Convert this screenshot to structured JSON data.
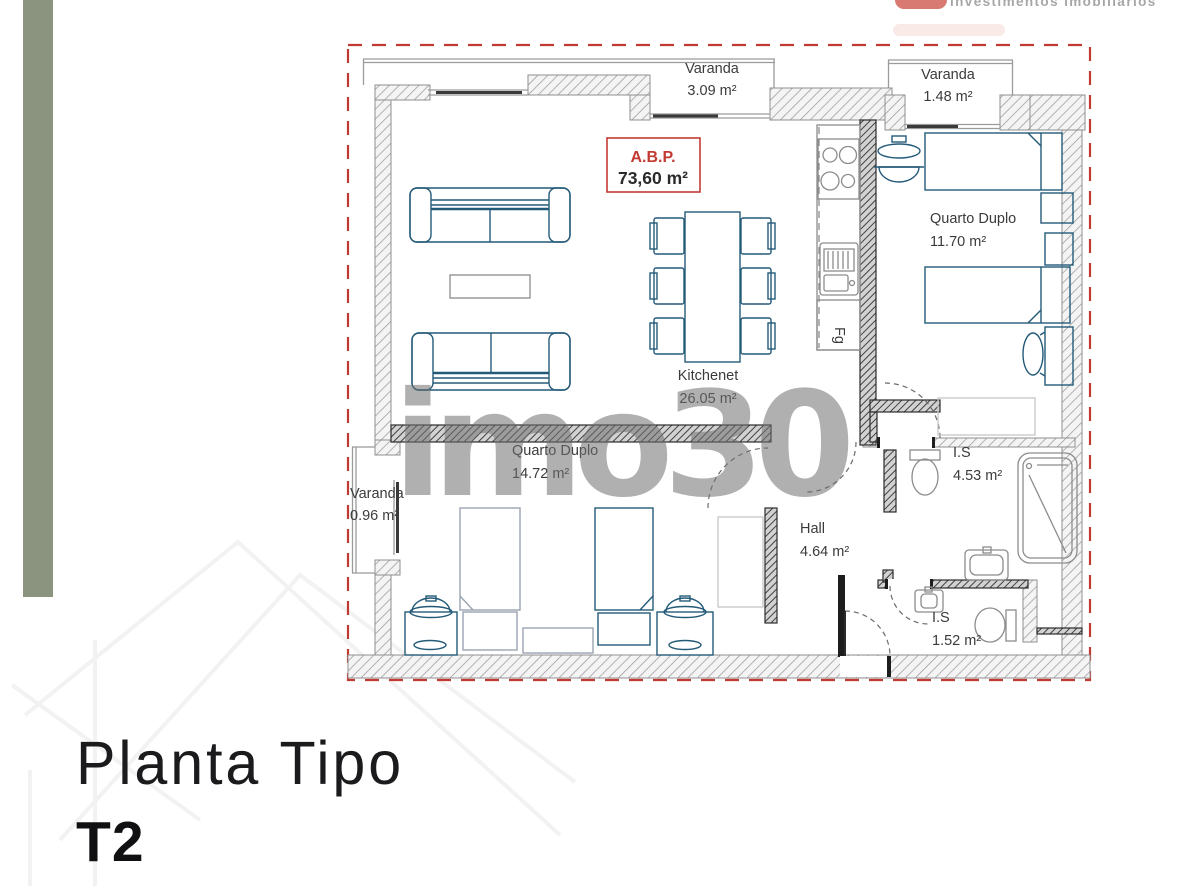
{
  "colors": {
    "accent_red": "#c23b33",
    "sage_bar": "#8b947f",
    "furniture_blue": "#235a78",
    "watermark_gray": "#707070",
    "label_text": "#3b3b3b"
  },
  "header": {
    "logo_tagline": "investimentos imobiliários"
  },
  "watermark": {
    "text": "imo30"
  },
  "floorplan": {
    "abp": {
      "label": "A.B.P.",
      "area": "73,60 m²"
    },
    "rooms": [
      {
        "name": "Varanda",
        "area": "3.09 m²"
      },
      {
        "name": "Varanda",
        "area": "1.48 m²"
      },
      {
        "name": "Quarto Duplo",
        "area": "11.70 m²"
      },
      {
        "name": "Kitchenet",
        "area": "26.05 m²"
      },
      {
        "name": "Quarto Duplo",
        "area": "14.72 m²"
      },
      {
        "name": "Varanda",
        "area": "0.96 m²"
      },
      {
        "name": "Hall",
        "area": "4.64 m²"
      },
      {
        "name": "I.S",
        "area": "4.53 m²"
      },
      {
        "name": "I.S",
        "area": "1.52 m²"
      }
    ],
    "appliances": {
      "fridge": "Fg"
    }
  },
  "footer": {
    "title": "Planta Tipo",
    "type_label": "T2"
  }
}
